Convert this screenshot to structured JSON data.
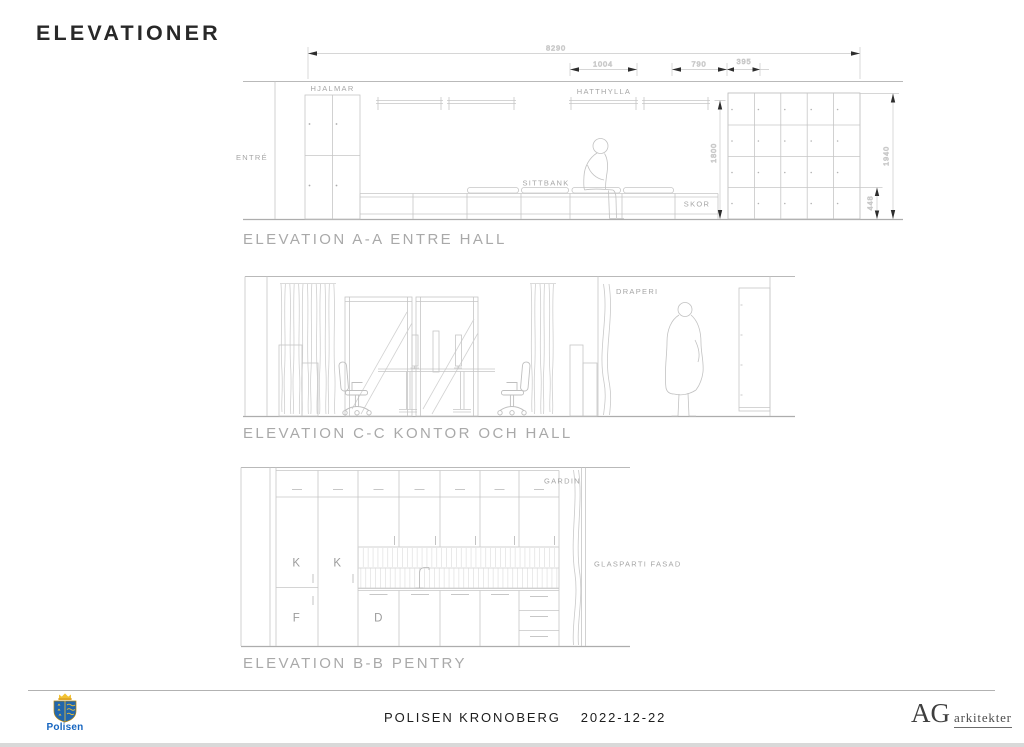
{
  "page": {
    "title": "ELEVATIONER"
  },
  "elevation_a": {
    "title": "ELEVATION A-A ENTRE HALL",
    "labels": {
      "entre": "ENTRÉ",
      "hjalmar": "HJALMAR",
      "hatthylla": "HATTHYLLA",
      "sittbank": "SITTBANK",
      "skor": "SKOR"
    },
    "dims": {
      "d8290": "8290",
      "d1004": "1004",
      "d790": "790",
      "d395": "395",
      "d1800": "1800",
      "d1940": "1940",
      "d448": "448"
    }
  },
  "elevation_c": {
    "title": "ELEVATION C-C KONTOR OCH HALL",
    "labels": {
      "draperi": "DRAPERI"
    }
  },
  "elevation_b": {
    "title": "ELEVATION B-B PENTRY",
    "labels": {
      "gardin": "GARDIN",
      "glasparti_fasad": "GLASPARTI FASAD",
      "fridge_1": "K",
      "fridge_2": "K",
      "freezer": "F",
      "dishwasher": "D"
    }
  },
  "footer": {
    "client": "POLISEN KRONOBERG",
    "date": "2022-12-22",
    "police_logo_text": "Polisen",
    "architect_initials": "AG",
    "architect_name": "arkitekter"
  },
  "colors": {
    "drawing_line": "#c6c6c6",
    "drawing_strong_line": "#adadad",
    "drawing_label": "#a6a6a6",
    "drawing_title": "#a9a9a9",
    "dimension_text": "#b8b8b8",
    "dimension_arrow": "#2e2e2e",
    "header_text": "#282828",
    "footer_text": "#1d1d1d",
    "police_blue": "#1565c0",
    "police_gold": "#f2c233"
  }
}
